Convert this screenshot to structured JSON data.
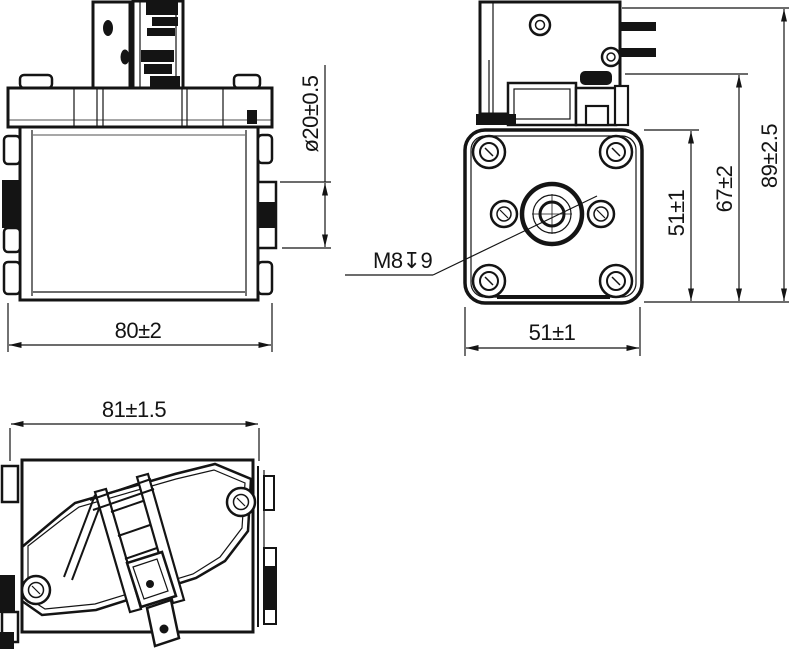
{
  "colors": {
    "background": "#ffffff",
    "ink": "#141414"
  },
  "views": {
    "side_elevation": {
      "dims": {
        "boss_diameter": "ø20±0.5",
        "body_width": "80±2"
      }
    },
    "front_face": {
      "dims": {
        "thread_depth": "M8↧9",
        "mount_height": "51±1",
        "housing_height": "67±2",
        "overall_height": "89±2.5",
        "mount_width": "51±1"
      }
    },
    "top_view": {
      "dims": {
        "overall_width": "81±1.5"
      }
    }
  }
}
